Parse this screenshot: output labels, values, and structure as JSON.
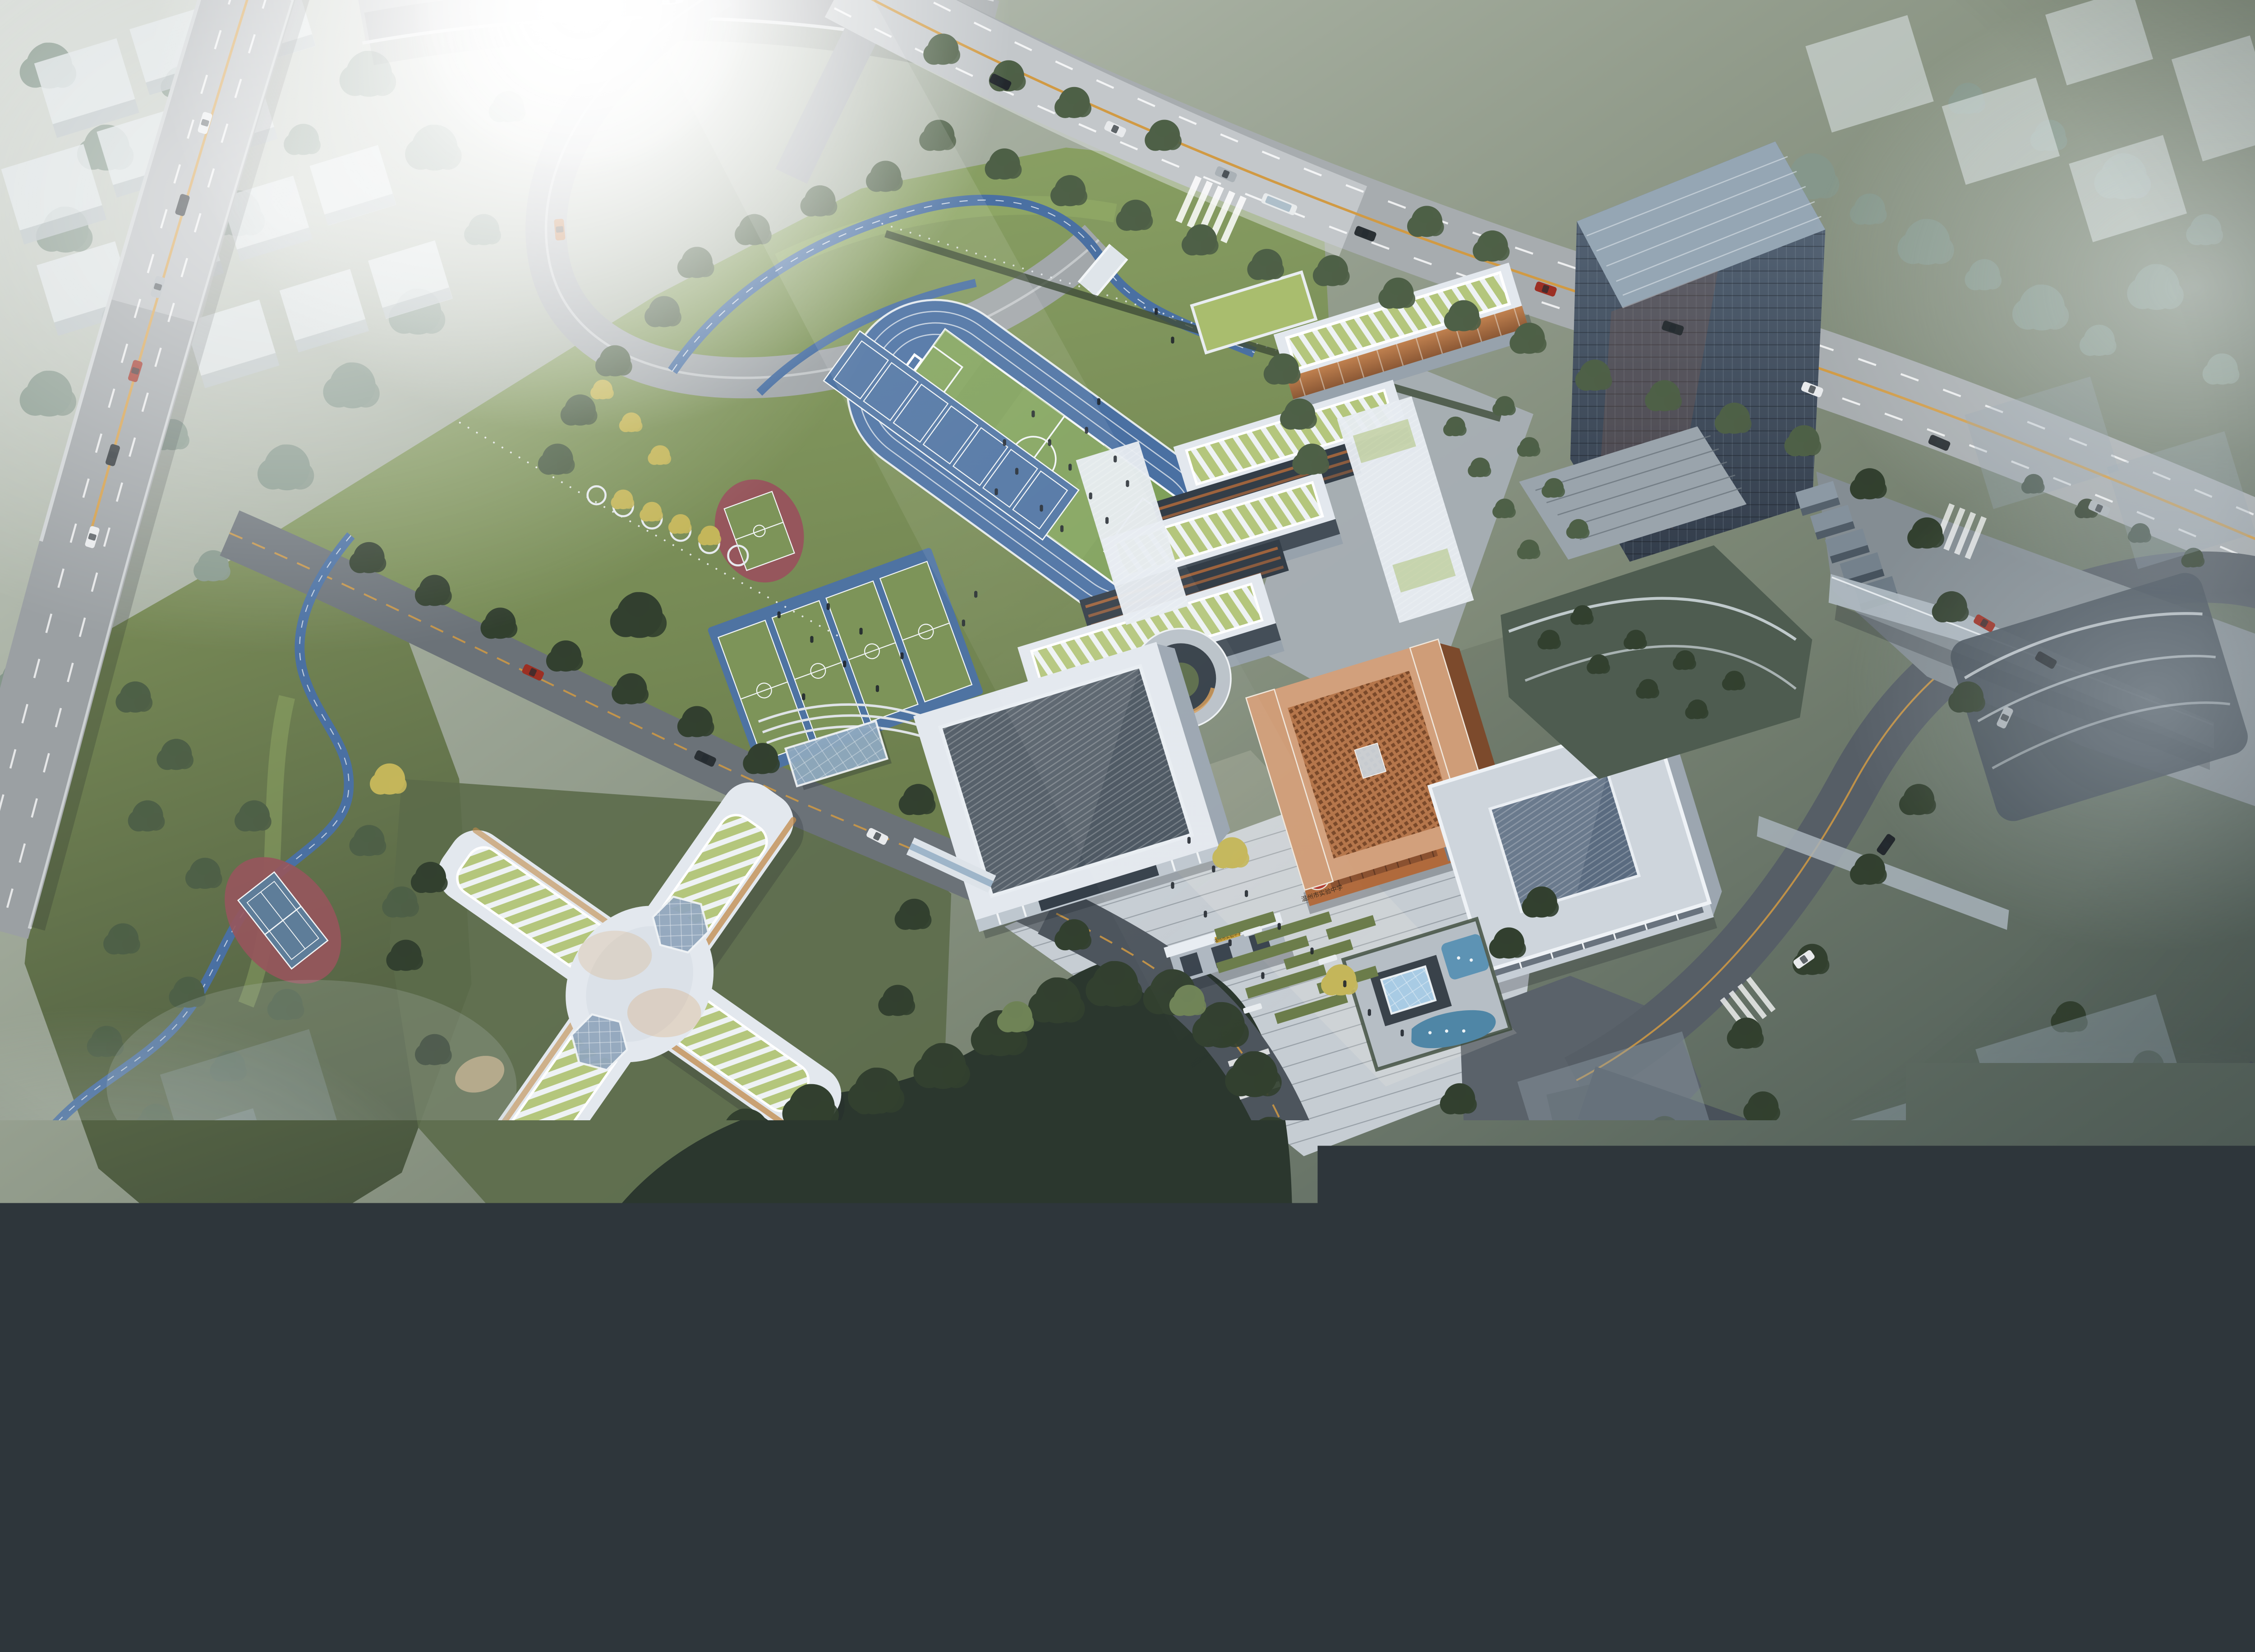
{
  "signage": {
    "seal_glyph": "實",
    "library_name": "温州市实验中学",
    "gate_plaque": "温州市实验中学"
  },
  "features": {
    "running_track_lanes": 6,
    "basketball_courts": 4,
    "badminton_courts": 7,
    "tennis_courts": 1,
    "soccer_fields": 1,
    "hex_skylights": 2
  },
  "palette": {
    "base_light": "#d2d7d2",
    "base_mid": "#8a9484",
    "base_dark": "#3f4b49",
    "fog_white": "#e9eeee",
    "tree_green": "#4e6047",
    "tree_dark": "#32402f",
    "tree_light": "#6f8356",
    "tree_yellow": "#c4b65a",
    "tree_misty": "#85978b",
    "grass_bright": "#8fa768",
    "grass_mid": "#70824e",
    "grass_dark": "#4b5941",
    "forest_floor": "#2b372e",
    "track_blue": "#4a70a2",
    "court_blue": "#4e73a2",
    "court_green": "#7d9459",
    "court_red": "#96565c",
    "tennis_blue": "#5e7d99",
    "field_green": "#7fa05a",
    "line_white": "#f2f5f6",
    "road_light": "#a7acaf",
    "road_mid": "#6b7278",
    "road_dark": "#4d555d",
    "lane_yellow": "#d19a43",
    "highway_gray": "#9ba0a3",
    "bldg_white": "#e3e8ee",
    "bldg_wall": "#b7c0c9",
    "bldg_shadow": "#97a2ac",
    "roof_stripe_green": "#b4c67c",
    "roof_green": "#a9bd6e",
    "glass_dark": "#353f49",
    "warm_glow": "#d99d56",
    "orange_facade": "#b06a3c",
    "copper_light": "#d2a07c",
    "copper_mid": "#b5764b",
    "copper_dark": "#6b3d22",
    "seal_red": "#b23b30",
    "tower_glass_top": "#5a6a7c",
    "tower_glass_bottom": "#333d4b",
    "tower_cap": "#95a6b4",
    "fog_block": "#93a2ad",
    "cube_white": "#dfe5e7",
    "water_blue": "#5d93b4",
    "plaza_light": "#c6cdd3",
    "plaza_green": "#6b7c4a",
    "paving_gray": "#a8b0b6"
  }
}
